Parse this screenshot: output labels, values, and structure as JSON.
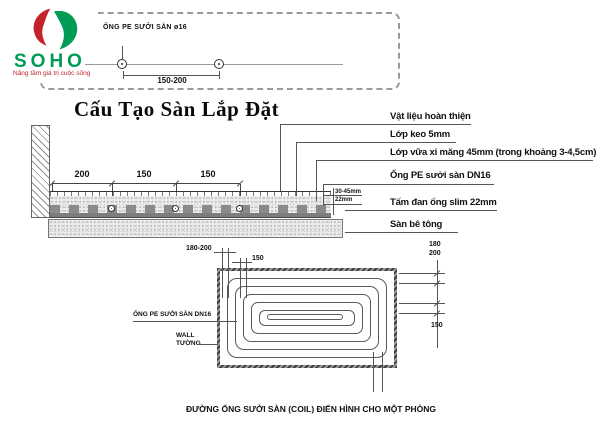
{
  "logo": {
    "brand": "SOHO",
    "tagline": "Nâng tầm giá trị cuộc sống",
    "red": "#c4232b",
    "green": "#009b55"
  },
  "top_detail": {
    "label": "ỐNG PE SƯỞI SÀN ø16",
    "dimension": "150-200"
  },
  "title": "Cấu Tạo Sàn Lắp Đặt",
  "section": {
    "dims": [
      "200",
      "150",
      "150"
    ],
    "thickness_labels": [
      "30-45mm",
      "22mm"
    ],
    "layer_labels": [
      "Vật liệu hoàn thiện",
      "Lớp keo 5mm",
      "Lớp vữa xi măng 45mm (trong khoảng 3-4,5cm)",
      "Ống PE sưởi sàn DN16",
      "Tấm đan ống slim 22mm",
      "Sàn bê tông"
    ]
  },
  "plan": {
    "pipe_label": "ỐNG PE SƯỞI SÀN DN16",
    "wall_label_en": "WALL",
    "wall_label_vi": "TƯỜNG",
    "dim_top_left": "180-200",
    "dim_top_left_2": "150",
    "dim_right_1": "180",
    "dim_right_2": "200",
    "dim_right_3": "150",
    "caption": "ĐƯỜNG ỐNG SƯỞI SÀN (COIL) ĐIỂN HÌNH CHO MỘT PHÒNG"
  }
}
